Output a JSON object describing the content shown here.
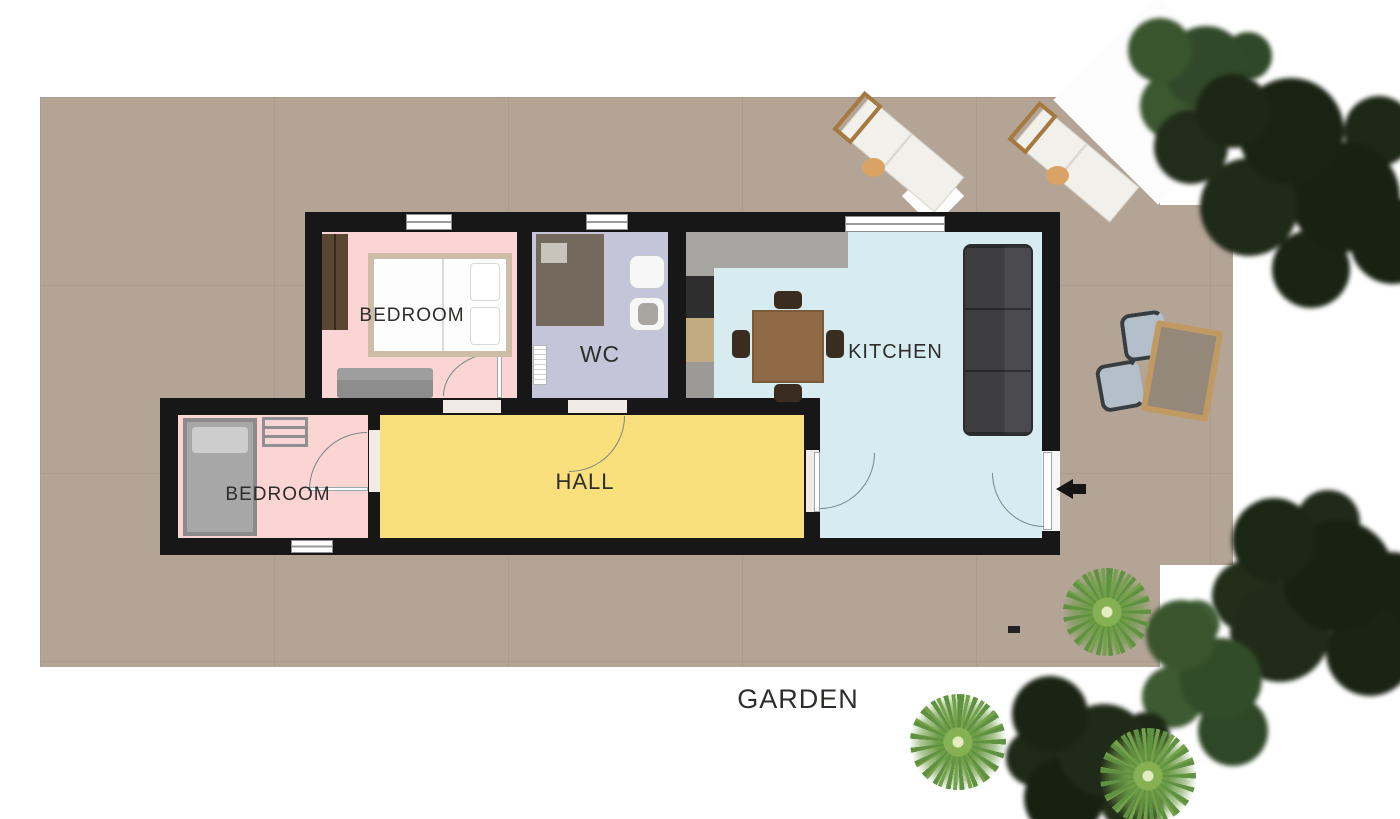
{
  "plan": {
    "rooms": [
      {
        "id": "bedroom-1",
        "label": "BEDROOM"
      },
      {
        "id": "wc",
        "label": "WC"
      },
      {
        "id": "kitchen",
        "label": "KITCHEN"
      },
      {
        "id": "hall",
        "label": "HALL"
      },
      {
        "id": "bedroom-2",
        "label": "BEDROOM"
      }
    ],
    "garden_label": "GARDEN",
    "entrance": {
      "icon": "entrance-arrow-icon",
      "direction": "left"
    },
    "colors": {
      "terrace": "#b3a496",
      "wall": "#171717",
      "bedroom_floor": "#fbd5d3",
      "wc_floor": "#c4c5d8",
      "kitchen_floor": "#d6ecf1",
      "hall_floor": "#f9e07c",
      "label_text": "#2e2d2b"
    }
  }
}
